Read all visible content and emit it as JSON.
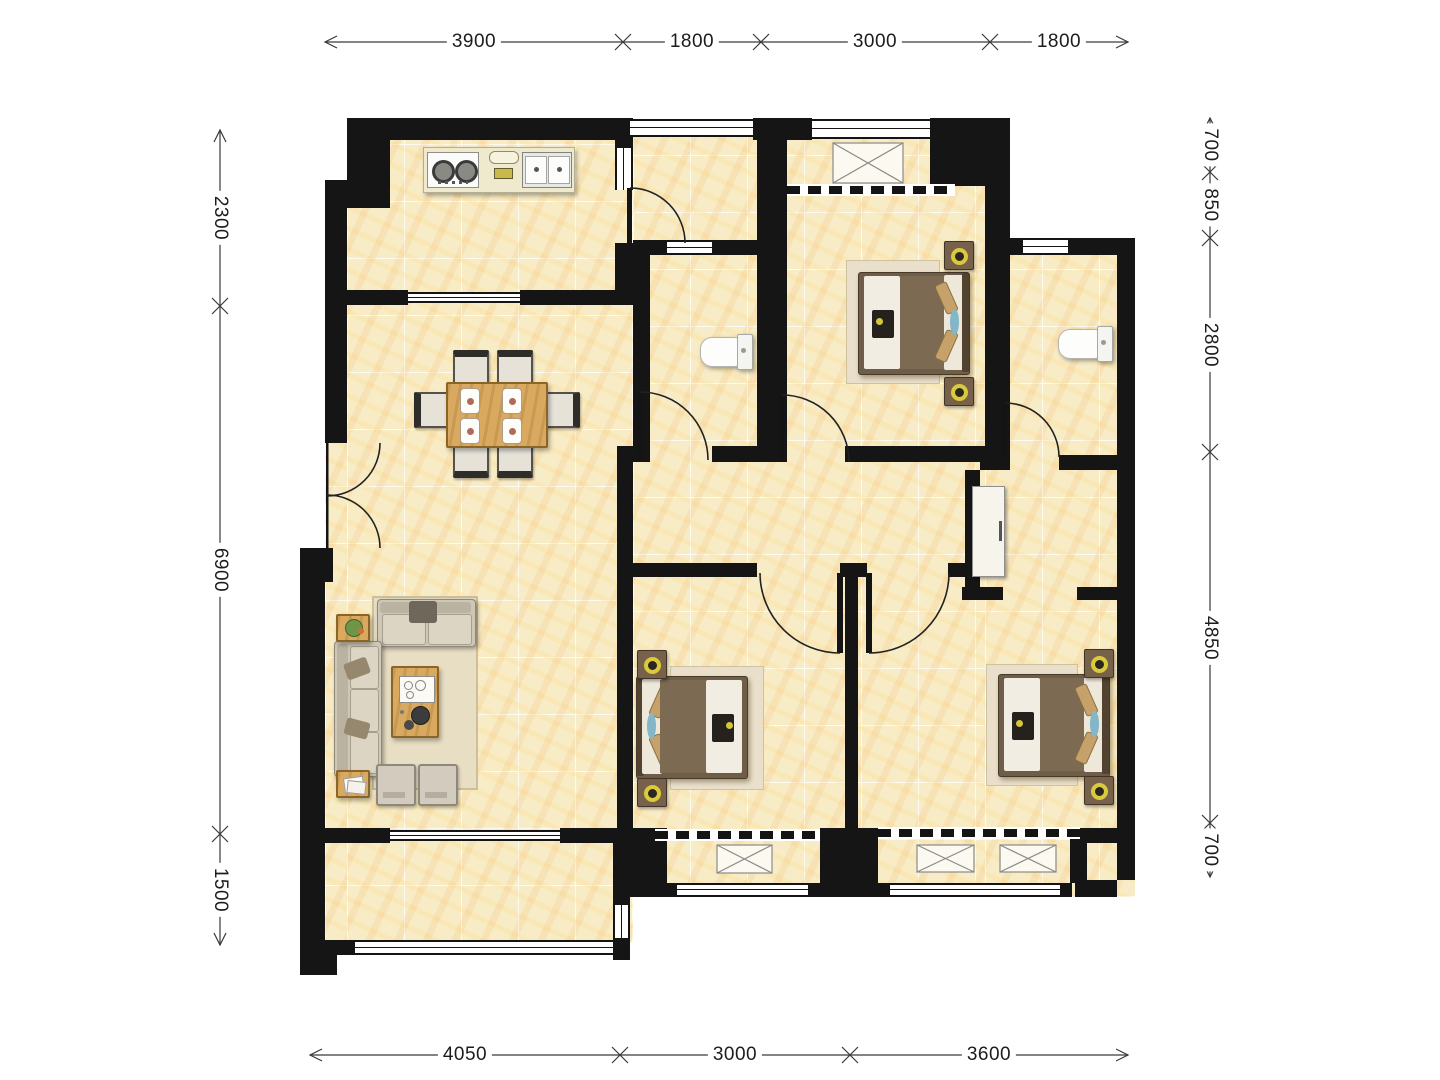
{
  "title": "apartment-floor-plan",
  "dimensions": {
    "top": [
      "3900",
      "1800",
      "3000",
      "1800"
    ],
    "bottom": [
      "4050",
      "3000",
      "3600"
    ],
    "left": [
      "2300",
      "6900",
      "1500"
    ],
    "right": [
      "700",
      "850",
      "2800",
      "4850",
      "700"
    ]
  },
  "palette": {
    "wall": "#151515",
    "floor_tile": "#f8ecc6",
    "floor_vein": "#f0a94e",
    "wood": "#d9a95f",
    "rug": "#e8dec4",
    "sofa": "#d9d2c2",
    "bed_blanket": "#7c6a53",
    "pillow_tan": "#c6a26a",
    "accent_blue": "#84b6ca",
    "lamp_yellow": "#d9c93c",
    "dimension_line": "#3a3a3a",
    "dimension_text": "#1c1c1c"
  }
}
